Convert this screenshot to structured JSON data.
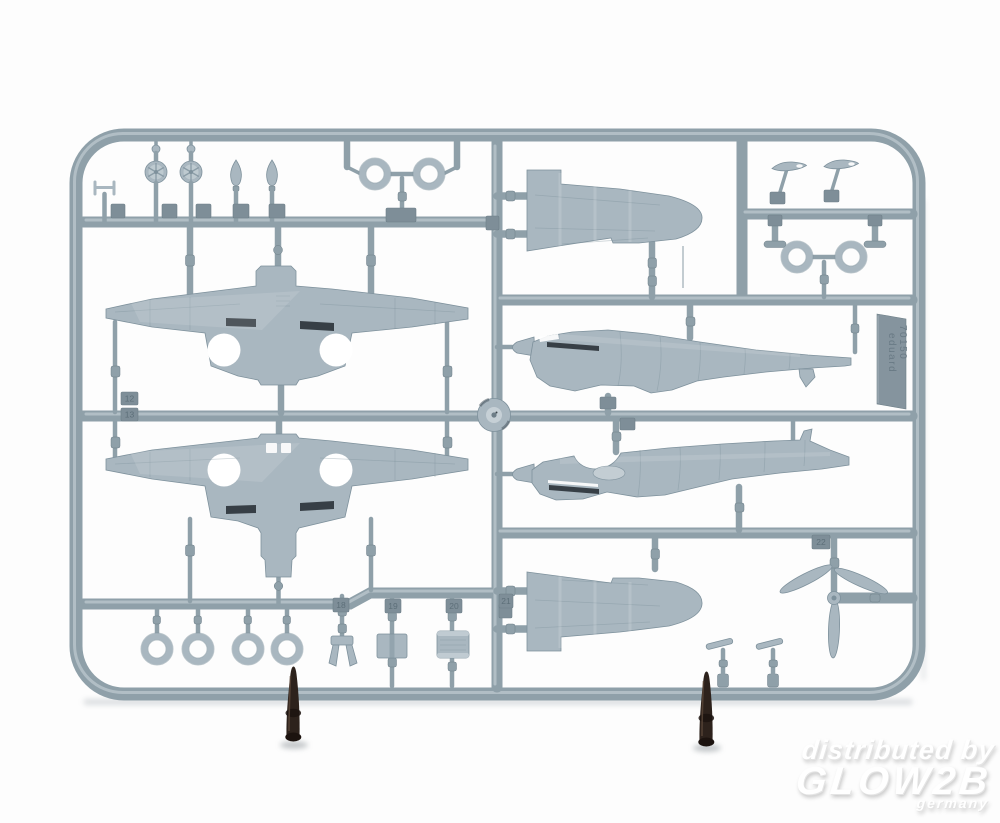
{
  "scene": {
    "subject": "Photo of a grey injection-molded plastic model kit sprue with aircraft parts (wings, fuselage halves, wheels, propeller), propped upright on two dark cone stands"
  },
  "watermark": {
    "line1": "distributed by",
    "line2": "GLOW2B",
    "line3": "germany"
  },
  "sprue_label": {
    "number": "70150",
    "brand": "eduard"
  },
  "part_number_tabs": {
    "t12": "12",
    "t13": "13",
    "t18": "18",
    "t19": "19",
    "t20": "20",
    "t21": "21",
    "t22": "22"
  },
  "colors": {
    "background": "#fdfdfd",
    "runner": "#8fa0a9",
    "runner_highlight": "#bfcbd1",
    "runner_shadow": "#6e7f88",
    "part": "#a9b7c0",
    "part_light": "#c6d0d6",
    "part_dark": "#7e919c",
    "slot_dark": "#232a30",
    "tab": "#7e8e98",
    "cone": "#2d221c",
    "cone_highlight": "#5a4739",
    "watermark": "#ffffff",
    "shadow": "#b4babf"
  }
}
